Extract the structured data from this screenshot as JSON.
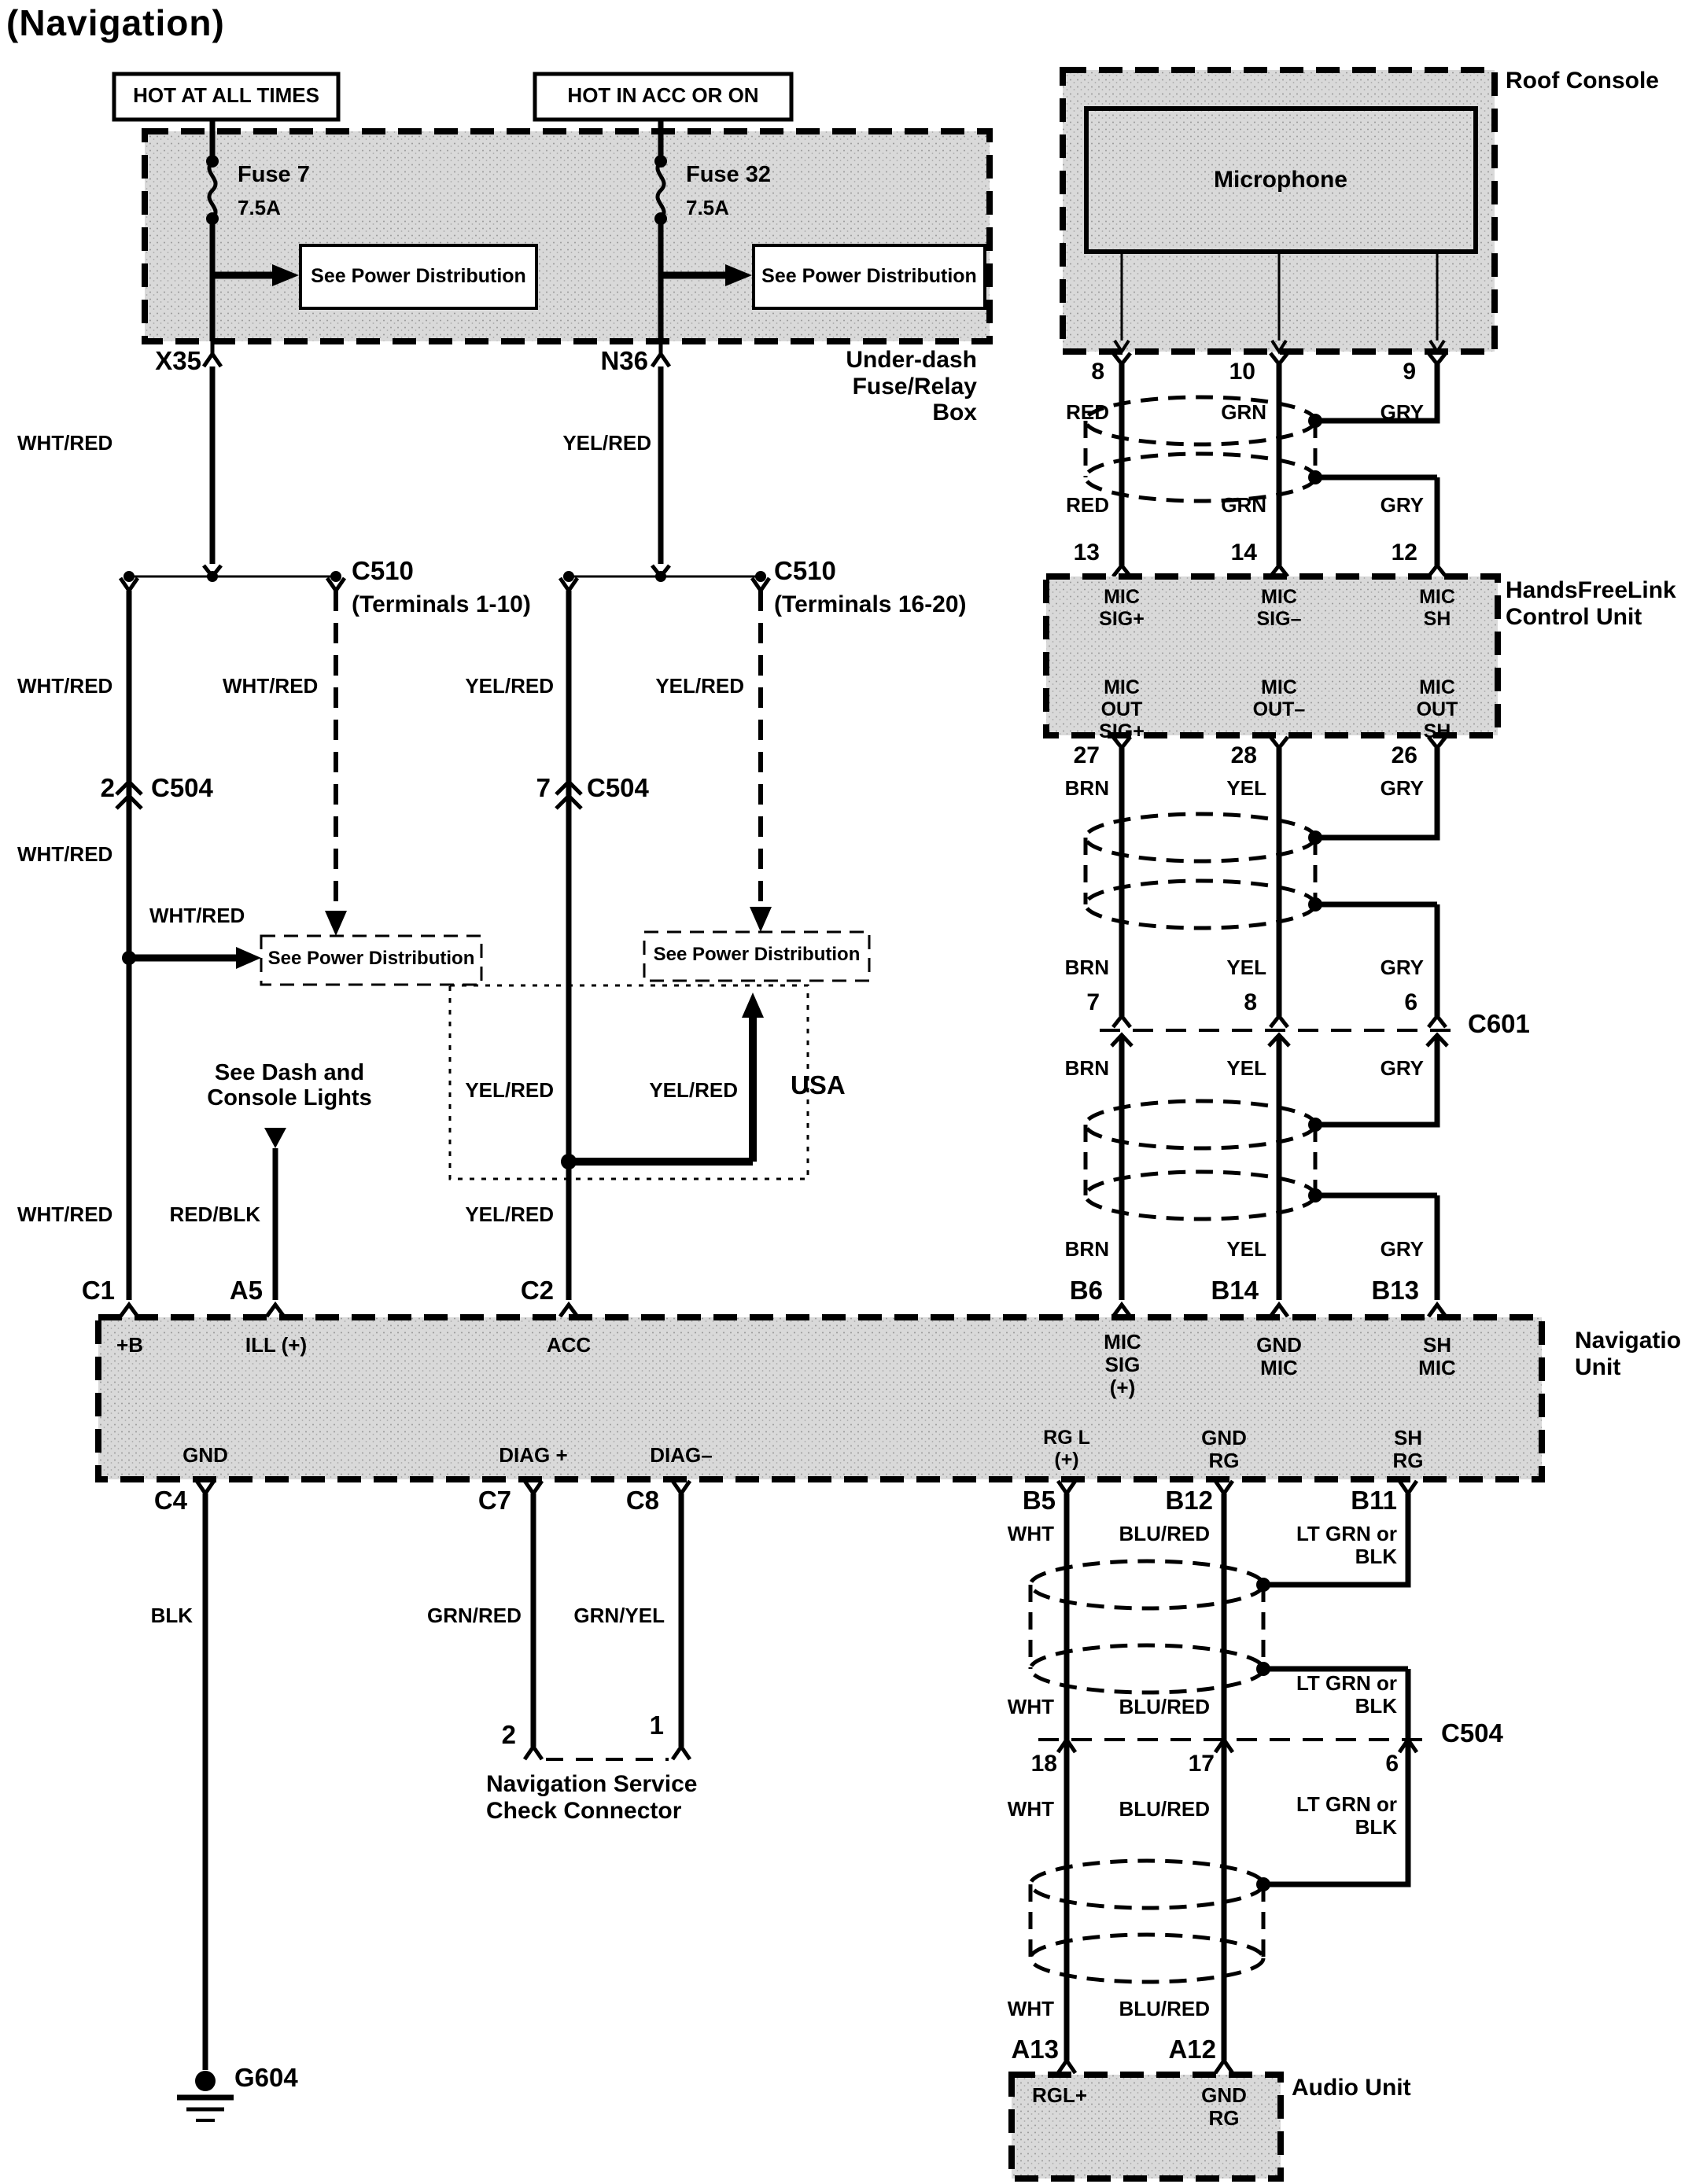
{
  "title": "(Navigation)",
  "colors": {
    "line": "#000000",
    "panel_fill": "#d8d8d8",
    "background": "#ffffff"
  },
  "power": {
    "hot_at_all_times": "HOT AT ALL TIMES",
    "hot_in_acc_or_on": "HOT IN ACC OR ON",
    "fuse7_name": "Fuse 7",
    "fuse7_rating": "7.5A",
    "fuse32_name": "Fuse 32",
    "fuse32_rating": "7.5A",
    "see_power_distribution": "See Power Distribution",
    "underdash_box": "Under-dash Fuse/Relay Box",
    "x35": "X35",
    "n36": "N36"
  },
  "wire_colors": {
    "wht_red": "WHT/RED",
    "yel_red": "YEL/RED",
    "red_blk": "RED/BLK",
    "blk": "BLK",
    "grn_red": "GRN/RED",
    "grn_yel": "GRN/YEL",
    "red": "RED",
    "grn": "GRN",
    "gry": "GRY",
    "brn": "BRN",
    "yel": "YEL",
    "wht": "WHT",
    "blu_red": "BLU/RED",
    "lt_grn_or_blk": "LT GRN or BLK"
  },
  "connectors": {
    "c510_left": "C510",
    "c510_left_terminals": "(Terminals 1-10)",
    "c510_right": "C510",
    "c510_right_terminals": "(Terminals 16-20)",
    "c504_left_pin": "2",
    "c504_left": "C504",
    "c504_right_pin": "7",
    "c504_right": "C504",
    "c601": "C601",
    "c504_lower": "C504",
    "c504_lower_pins": {
      "p18": "18",
      "p17": "17",
      "p6": "6"
    },
    "g604": "G604"
  },
  "notes": {
    "see_dash_and_console_lights": "See Dash and Console Lights",
    "usa": "USA"
  },
  "roof_console": {
    "label": "Roof Console",
    "microphone": "Microphone",
    "pins": {
      "p8": "8",
      "p10": "10",
      "p9": "9"
    }
  },
  "handsfreelink": {
    "label": "HandsFreeLink Control Unit",
    "pins_top": {
      "p13": "13",
      "p14": "14",
      "p12": "12"
    },
    "signals_top": {
      "mic_sig_plus": "MIC SIG+",
      "mic_sig_minus": "MIC SIG–",
      "mic_sh": "MIC SH"
    },
    "signals_bottom": {
      "mic_out_sig_plus": "MIC OUT SIG+",
      "mic_out_minus": "MIC OUT–",
      "mic_out_sh": "MIC OUT SH"
    },
    "pins_bottom": {
      "p27": "27",
      "p28": "28",
      "p26": "26"
    }
  },
  "c601_pins": {
    "p7": "7",
    "p8": "8",
    "p6": "6"
  },
  "navigation_unit": {
    "label": "Navigation Unit",
    "pins_top": {
      "c1": "C1",
      "a5": "A5",
      "c2": "C2",
      "b6": "B6",
      "b14": "B14",
      "b13": "B13"
    },
    "signals_top": {
      "plus_b": "+B",
      "ill_plus": "ILL (+)",
      "acc": "ACC",
      "mic_sig_plus": "MIC SIG (+)",
      "gnd_mic": "GND MIC",
      "sh_mic": "SH MIC"
    },
    "signals_bottom": {
      "gnd": "GND",
      "diag_plus": "DIAG +",
      "diag_minus": "DIAG–",
      "rg_l_plus": "RG L (+)",
      "gnd_rg": "GND RG",
      "sh_rg": "SH RG"
    },
    "pins_bottom": {
      "c4": "C4",
      "c7": "C7",
      "c8": "C8",
      "b5": "B5",
      "b12": "B12",
      "b11": "B11"
    }
  },
  "service_connector": {
    "pin2": "2",
    "pin1": "1",
    "label": "Navigation Service Check Connector"
  },
  "audio_unit": {
    "label": "Audio Unit",
    "pins": {
      "a13": "A13",
      "a12": "A12"
    },
    "signals": {
      "rgl_plus": "RGL+",
      "gnd_rg": "GND RG"
    }
  }
}
